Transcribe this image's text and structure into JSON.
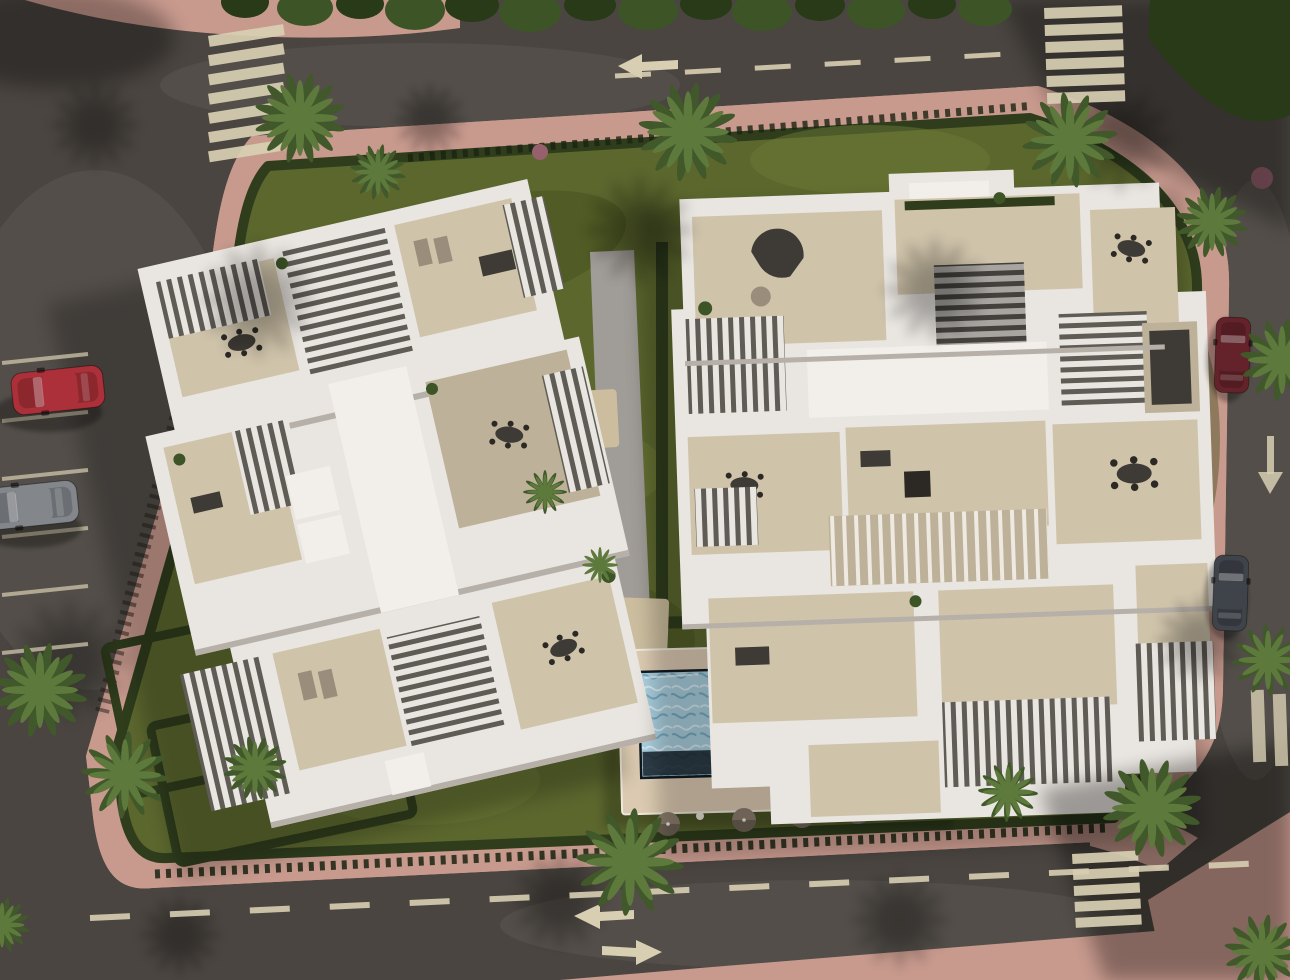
{
  "meta": {
    "type": "architectural-aerial-render",
    "description": "Aerial top-down photorealistic rendering of a residential complex: two white modern apartment buildings with rooftop terraces, pergolas and stairwells, a communal garden with palm trees and hedges, a long rectangular swimming pool with sun deck and two shade pergolas, a garage ramp, surrounded by asphalt roads with zebra crosswalks, dashed lane lines, direction arrows, pink paved sidewalks and parked cars.",
    "time_of_day": "low sun with long shadows cast toward the south-west",
    "style": "photorealistic CGI site plan view"
  },
  "colors": {
    "asphalt": "#4a4540",
    "sidewalk": "#c89a8e",
    "sidewalkDark": "#a87b72",
    "grass": "#5c672e",
    "grassDark": "#47521f",
    "grassLight": "#6b7836",
    "hedge": "#2f3d1d",
    "canopy": "#3d5526",
    "canopyDark": "#283a17",
    "building": "#e9e5e0",
    "buildingHi": "#f2efeb",
    "buildingShade": "#b6b0a9",
    "terrace": "#cfc3aa",
    "terraceDark": "#bdb199",
    "slatDark": "#5f5b55",
    "pathGray": "#a09c97",
    "sand": "#cbbd9e",
    "deck": "#dbcab1",
    "water": "#a9cedd",
    "waterDeep": "#16212c",
    "marking": "#d8cfb3",
    "brick": "#4e3931",
    "brickDark": "#3f2f2a",
    "ramp": "#31302e",
    "palm": "#5d7a3c",
    "palmDark": "#41592a",
    "carRed": "#ab3039",
    "carMaroon": "#64232a",
    "carSilver": "#83878c",
    "carDark": "#3f434a"
  },
  "objects": {
    "building_count": 2,
    "buildings": [
      "west-apartment-building-rotated",
      "east-apartment-building"
    ],
    "pool": {
      "shape": "long-rectangle",
      "deck": "beige",
      "deep_end": "dark-right",
      "pergolas": 2,
      "umbrellas": 4
    },
    "cars": [
      {
        "color": "red",
        "location": "west-road-parking-bay"
      },
      {
        "color": "silver",
        "location": "west-road-parking-bay"
      },
      {
        "color": "dark-red",
        "location": "east-road"
      },
      {
        "color": "dark-gray",
        "location": "east-road"
      }
    ],
    "crosswalk_count": 3,
    "road_arrows": [
      "left-top-road",
      "down-east-road",
      "left-bottom-road",
      "right-bottom-road"
    ],
    "palm_tree_count": 16,
    "garage_ramp": "south-east of east building"
  }
}
